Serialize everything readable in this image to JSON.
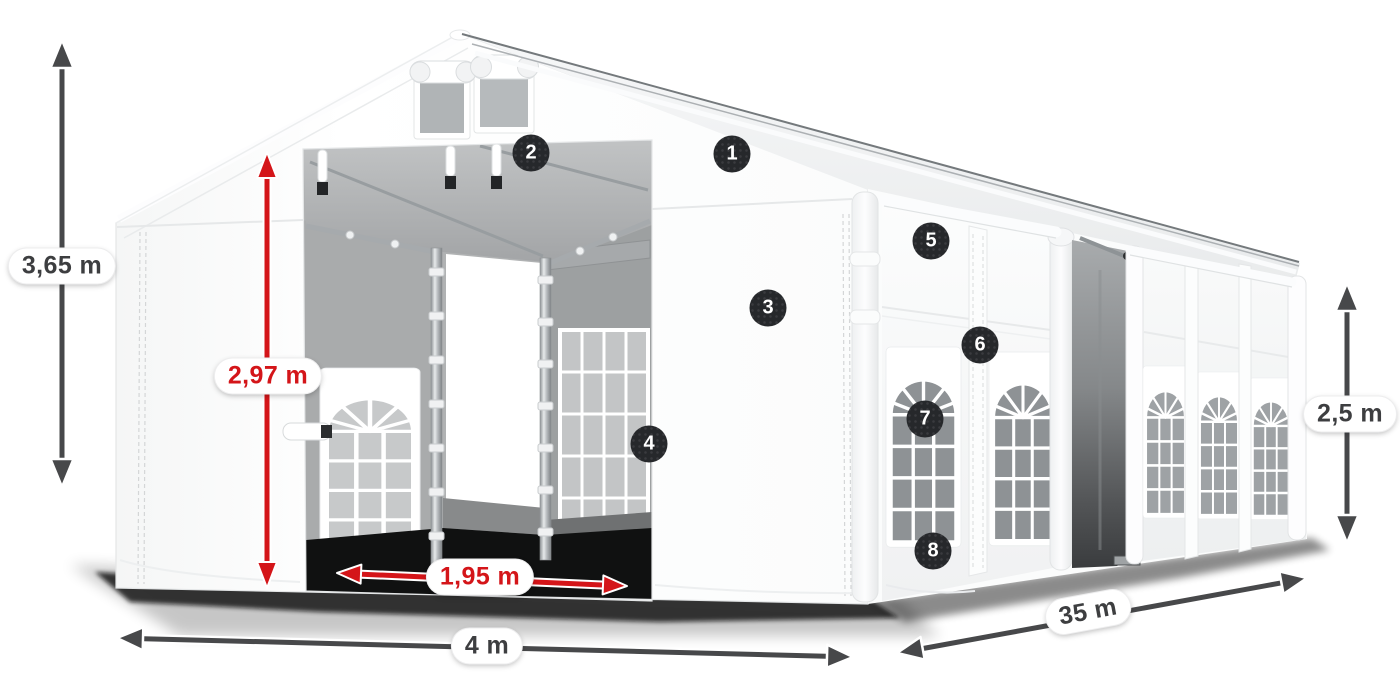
{
  "figure": {
    "alt": "White marquee party tent shown in perspective with numbered part callouts and dimension arrows"
  },
  "dimensions": {
    "total_height": "3,65 m",
    "entrance_height": "2,97 m",
    "entrance_width": "1,95 m",
    "width": "4 m",
    "length": "35 m",
    "side_height": "2,5 m"
  },
  "callouts": [
    "1",
    "2",
    "3",
    "4",
    "5",
    "6",
    "7",
    "8"
  ],
  "colors": {
    "background": "#ffffff",
    "tent_white": "#ffffff",
    "interior_gray": "#a9abac",
    "accent_red": "#d41519",
    "arrow_dark": "#47484a",
    "badge_background": "#26282b",
    "label_text_dark": "#3d3e40"
  }
}
